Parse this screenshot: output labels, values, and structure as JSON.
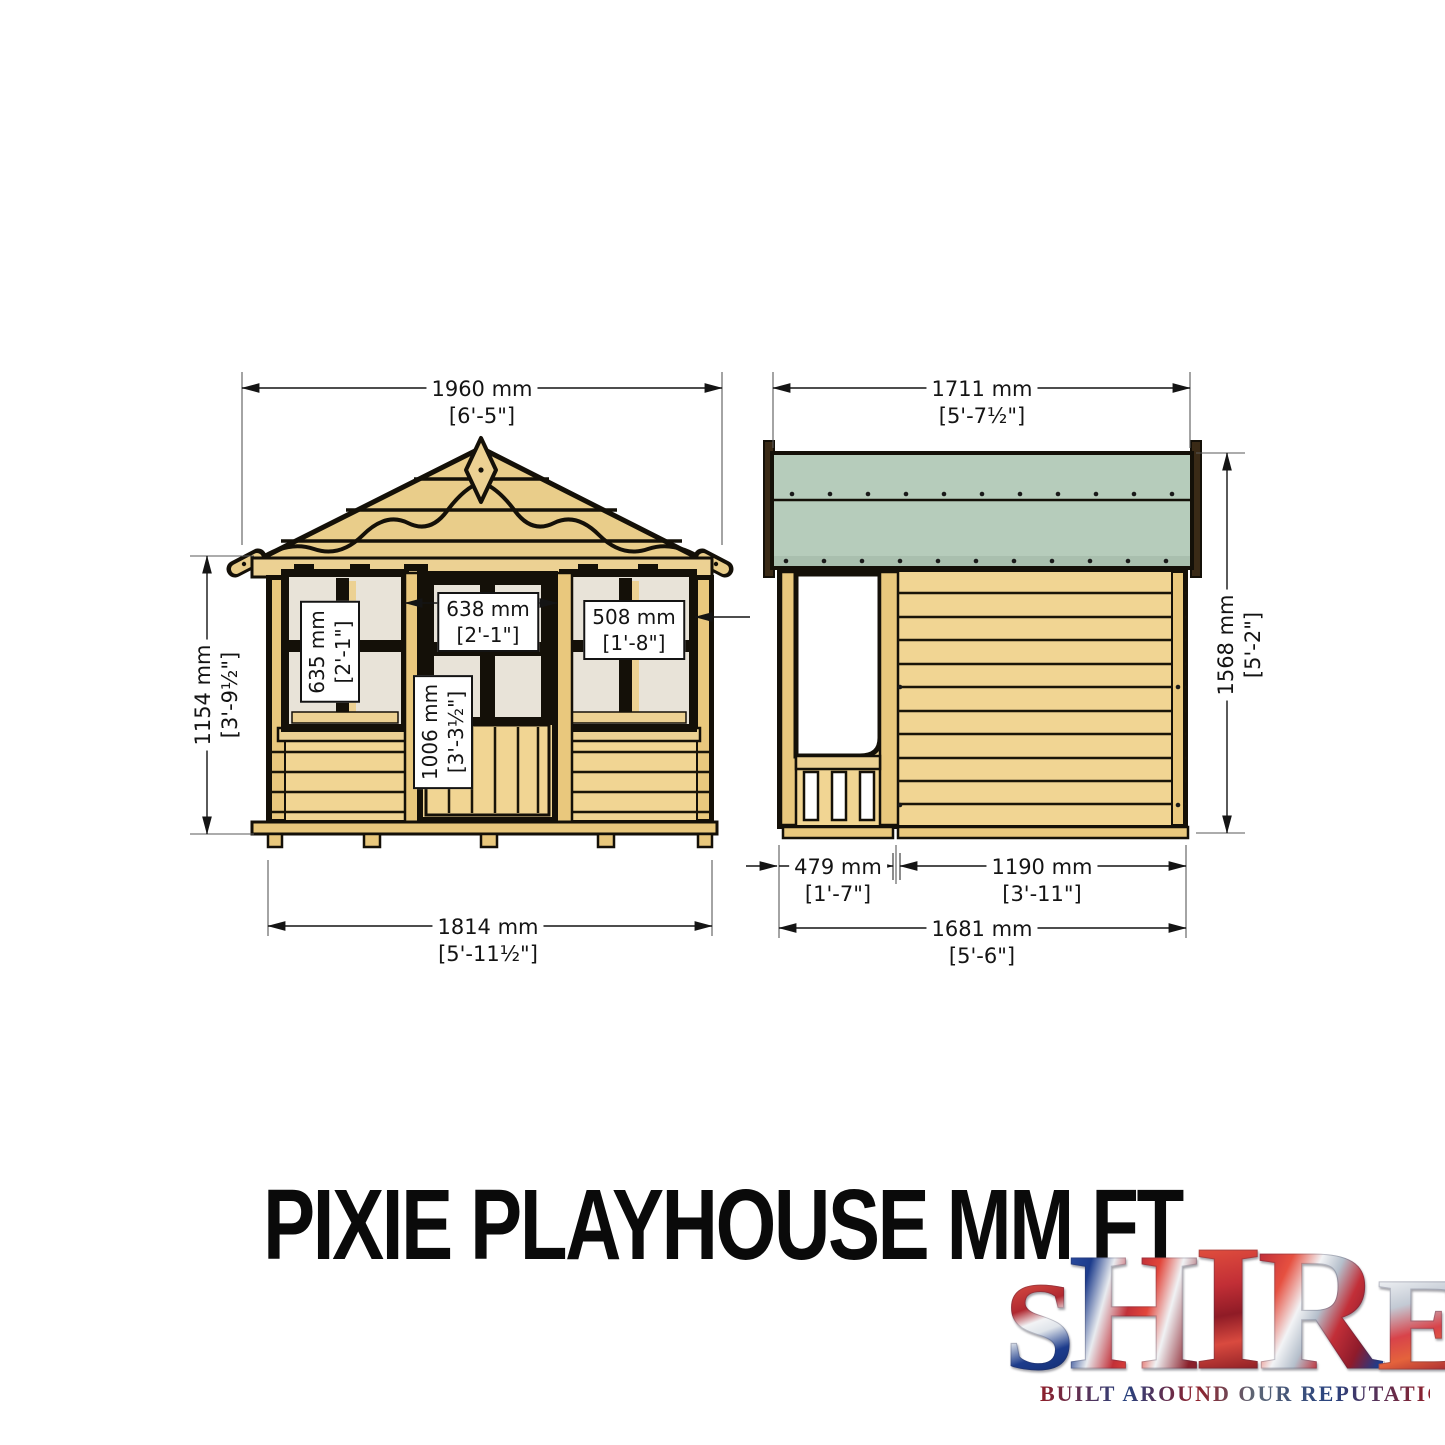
{
  "title": "PIXIE PLAYHOUSE MM FT",
  "front_view": {
    "label": "front elevation drawing",
    "dim_width_top": {
      "mm": "1960 mm",
      "ft": "[6'-5\"]"
    },
    "dim_height_left": {
      "mm": "1154 mm",
      "ft": "[3'-9½\"]"
    },
    "dim_width_bottom": {
      "mm": "1814 mm",
      "ft": "[5'-11½\"]"
    },
    "dim_window_left": {
      "mm": "635 mm",
      "ft": "[2'-1\"]"
    },
    "dim_door_width": {
      "mm": "638 mm",
      "ft": "[2'-1\"]"
    },
    "dim_window_right": {
      "mm": "508 mm",
      "ft": "[1'-8\"]"
    },
    "dim_door_height": {
      "mm": "1006 mm",
      "ft": "[3'-3½\"]"
    }
  },
  "side_view": {
    "label": "side elevation drawing",
    "dim_width_top": {
      "mm": "1711 mm",
      "ft": "[5'-7½\"]"
    },
    "dim_height_right": {
      "mm": "1568 mm",
      "ft": "[5'-2\"]"
    },
    "dim_porch_depth": {
      "mm": "479 mm",
      "ft": "[1'-7\"]"
    },
    "dim_wall_depth": {
      "mm": "1190 mm",
      "ft": "[3'-11\"]"
    },
    "dim_width_bottom": {
      "mm": "1681 mm",
      "ft": "[5'-6\"]"
    }
  },
  "logo": {
    "letters": [
      "S",
      "H",
      "I",
      "R",
      "E"
    ],
    "tagline": "BUILT AROUND OUR REPUTATION"
  },
  "colors": {
    "wood": "#f1d593",
    "wood_dark": "#e9c87d",
    "roof_green": "#b6ccbb",
    "barge_brown": "#3a2a16",
    "window_pane": "#e8e3d8",
    "outline": "#141008",
    "logo_red": "#c8102e",
    "logo_blue": "#1d3c8c"
  }
}
